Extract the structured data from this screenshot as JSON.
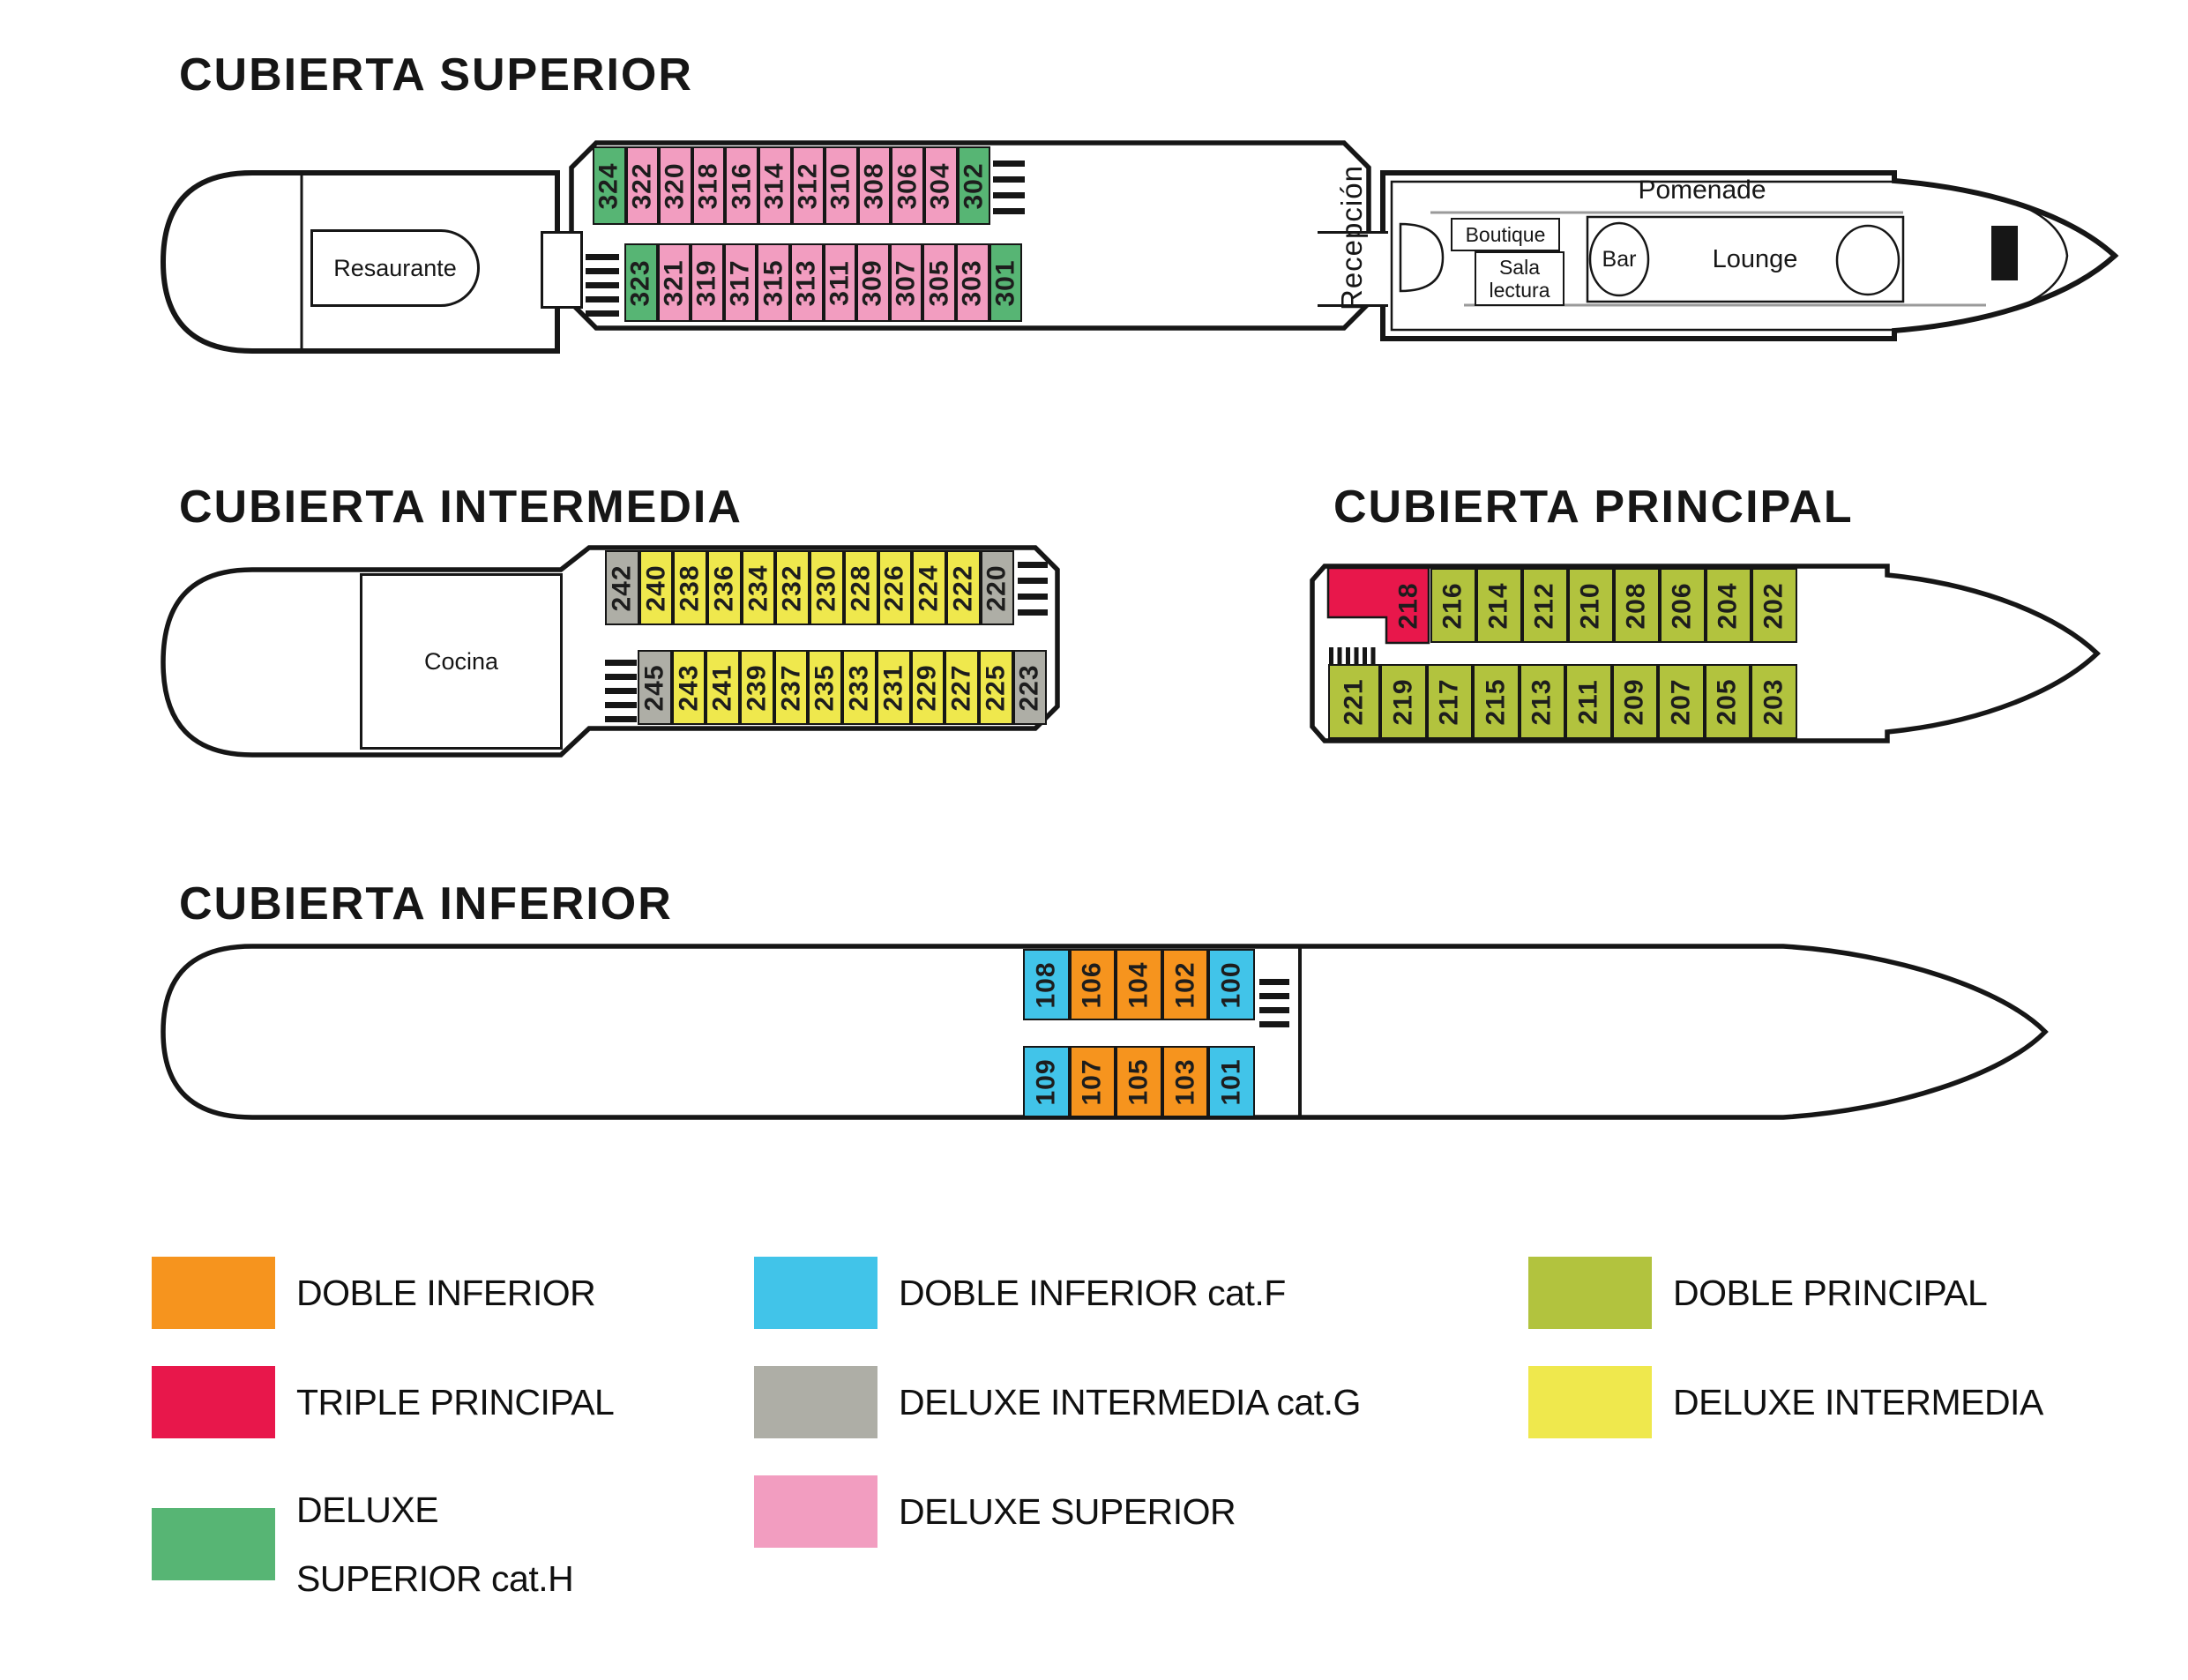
{
  "colors": {
    "orange": "#F6941E",
    "red": "#E8174B",
    "green": "#57B574",
    "cyan": "#41C4E9",
    "gray": "#AEAEA6",
    "pink": "#F29DC0",
    "olive": "#B2C33E",
    "yellow": "#EFE84D",
    "hull": "#161616",
    "promenade_line": "#9A9A9A"
  },
  "decks": {
    "superior": {
      "title": "CUBIERTA SUPERIOR",
      "stern_label": "Resaurante",
      "bow": {
        "reception": "Recepción",
        "promenade": "Pomenade",
        "boutique": "Boutique",
        "sala_line1": "Sala",
        "sala_line2": "lectura",
        "bar": "Bar",
        "lounge": "Lounge"
      },
      "rows": [
        [
          {
            "n": "324",
            "c": "green"
          },
          {
            "n": "322",
            "c": "pink"
          },
          {
            "n": "320",
            "c": "pink"
          },
          {
            "n": "318",
            "c": "pink"
          },
          {
            "n": "316",
            "c": "pink"
          },
          {
            "n": "314",
            "c": "pink"
          },
          {
            "n": "312",
            "c": "pink"
          },
          {
            "n": "310",
            "c": "pink"
          },
          {
            "n": "308",
            "c": "pink"
          },
          {
            "n": "306",
            "c": "pink"
          },
          {
            "n": "304",
            "c": "pink"
          },
          {
            "n": "302",
            "c": "green"
          }
        ],
        [
          {
            "n": "323",
            "c": "green"
          },
          {
            "n": "321",
            "c": "pink"
          },
          {
            "n": "319",
            "c": "pink"
          },
          {
            "n": "317",
            "c": "pink"
          },
          {
            "n": "315",
            "c": "pink"
          },
          {
            "n": "313",
            "c": "pink"
          },
          {
            "n": "311",
            "c": "pink"
          },
          {
            "n": "309",
            "c": "pink"
          },
          {
            "n": "307",
            "c": "pink"
          },
          {
            "n": "305",
            "c": "pink"
          },
          {
            "n": "303",
            "c": "pink"
          },
          {
            "n": "301",
            "c": "green"
          }
        ]
      ]
    },
    "intermedia": {
      "title": "CUBIERTA INTERMEDIA",
      "stern_label": "Cocina",
      "rows": [
        [
          {
            "n": "242",
            "c": "gray"
          },
          {
            "n": "240",
            "c": "yellow"
          },
          {
            "n": "238",
            "c": "yellow"
          },
          {
            "n": "236",
            "c": "yellow"
          },
          {
            "n": "234",
            "c": "yellow"
          },
          {
            "n": "232",
            "c": "yellow"
          },
          {
            "n": "230",
            "c": "yellow"
          },
          {
            "n": "228",
            "c": "yellow"
          },
          {
            "n": "226",
            "c": "yellow"
          },
          {
            "n": "224",
            "c": "yellow"
          },
          {
            "n": "222",
            "c": "yellow"
          },
          {
            "n": "220",
            "c": "gray"
          }
        ],
        [
          {
            "n": "245",
            "c": "gray"
          },
          {
            "n": "243",
            "c": "yellow"
          },
          {
            "n": "241",
            "c": "yellow"
          },
          {
            "n": "239",
            "c": "yellow"
          },
          {
            "n": "237",
            "c": "yellow"
          },
          {
            "n": "235",
            "c": "yellow"
          },
          {
            "n": "233",
            "c": "yellow"
          },
          {
            "n": "231",
            "c": "yellow"
          },
          {
            "n": "229",
            "c": "yellow"
          },
          {
            "n": "227",
            "c": "yellow"
          },
          {
            "n": "225",
            "c": "yellow"
          },
          {
            "n": "223",
            "c": "gray"
          }
        ]
      ]
    },
    "principal": {
      "title": "CUBIERTA PRINCIPAL",
      "special": {
        "n": "218",
        "c": "red"
      },
      "rows": [
        [
          {
            "n": "216",
            "c": "olive"
          },
          {
            "n": "214",
            "c": "olive"
          },
          {
            "n": "212",
            "c": "olive"
          },
          {
            "n": "210",
            "c": "olive"
          },
          {
            "n": "208",
            "c": "olive"
          },
          {
            "n": "206",
            "c": "olive"
          },
          {
            "n": "204",
            "c": "olive"
          },
          {
            "n": "202",
            "c": "olive"
          }
        ],
        [
          {
            "n": "221",
            "c": "olive"
          },
          {
            "n": "219",
            "c": "olive"
          },
          {
            "n": "217",
            "c": "olive"
          },
          {
            "n": "215",
            "c": "olive"
          },
          {
            "n": "213",
            "c": "olive"
          },
          {
            "n": "211",
            "c": "olive"
          },
          {
            "n": "209",
            "c": "olive"
          },
          {
            "n": "207",
            "c": "olive"
          },
          {
            "n": "205",
            "c": "olive"
          },
          {
            "n": "203",
            "c": "olive"
          }
        ]
      ]
    },
    "inferior": {
      "title": "CUBIERTA INFERIOR",
      "rows": [
        [
          {
            "n": "108",
            "c": "cyan"
          },
          {
            "n": "106",
            "c": "orange"
          },
          {
            "n": "104",
            "c": "orange"
          },
          {
            "n": "102",
            "c": "orange"
          },
          {
            "n": "100",
            "c": "cyan"
          }
        ],
        [
          {
            "n": "109",
            "c": "cyan"
          },
          {
            "n": "107",
            "c": "orange"
          },
          {
            "n": "105",
            "c": "orange"
          },
          {
            "n": "103",
            "c": "orange"
          },
          {
            "n": "101",
            "c": "cyan"
          }
        ]
      ]
    }
  },
  "legend": {
    "col1": [
      {
        "key": "orange",
        "lines": [
          "DOBLE INFERIOR"
        ]
      },
      {
        "key": "red",
        "lines": [
          "TRIPLE PRINCIPAL"
        ]
      },
      {
        "key": "green",
        "lines": [
          "DELUXE",
          "SUPERIOR cat.H"
        ]
      }
    ],
    "col2": [
      {
        "key": "cyan",
        "lines": [
          "DOBLE INFERIOR cat.F"
        ]
      },
      {
        "key": "gray",
        "lines": [
          "DELUXE INTERMEDIA cat.G"
        ]
      },
      {
        "key": "pink",
        "lines": [
          "DELUXE SUPERIOR"
        ]
      }
    ],
    "col3": [
      {
        "key": "olive",
        "lines": [
          "DOBLE PRINCIPAL"
        ]
      },
      {
        "key": "yellow",
        "lines": [
          "DELUXE INTERMEDIA"
        ]
      }
    ]
  }
}
